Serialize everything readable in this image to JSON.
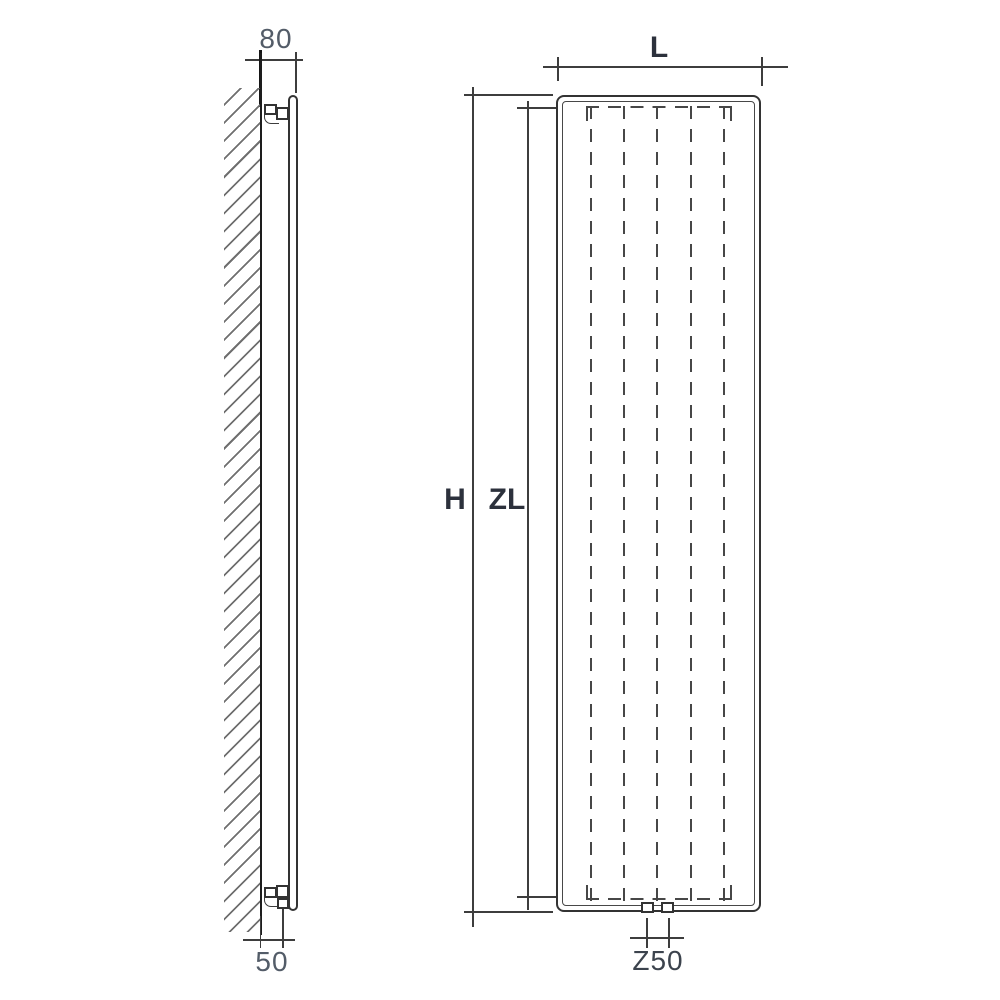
{
  "drawing": {
    "type": "technical-dimension-drawing",
    "subject": "vertical panel radiator, side view and front view",
    "side_view": {
      "dim_wall_depth": "80",
      "dim_wall_pipe_offset": "50"
    },
    "front_view": {
      "dim_length": "L",
      "dim_height": "H",
      "dim_element_height": "ZL",
      "dim_connection_spacing": "Z50"
    },
    "colors": {
      "background": "#ffffff",
      "line": "#3d3d3d",
      "line_dark": "#1d1d1d",
      "dashed_line": "#474747",
      "hatch": "#6f6f6f",
      "dim_number_text": "#535c68",
      "dim_letter_text": "#2c313c"
    }
  }
}
